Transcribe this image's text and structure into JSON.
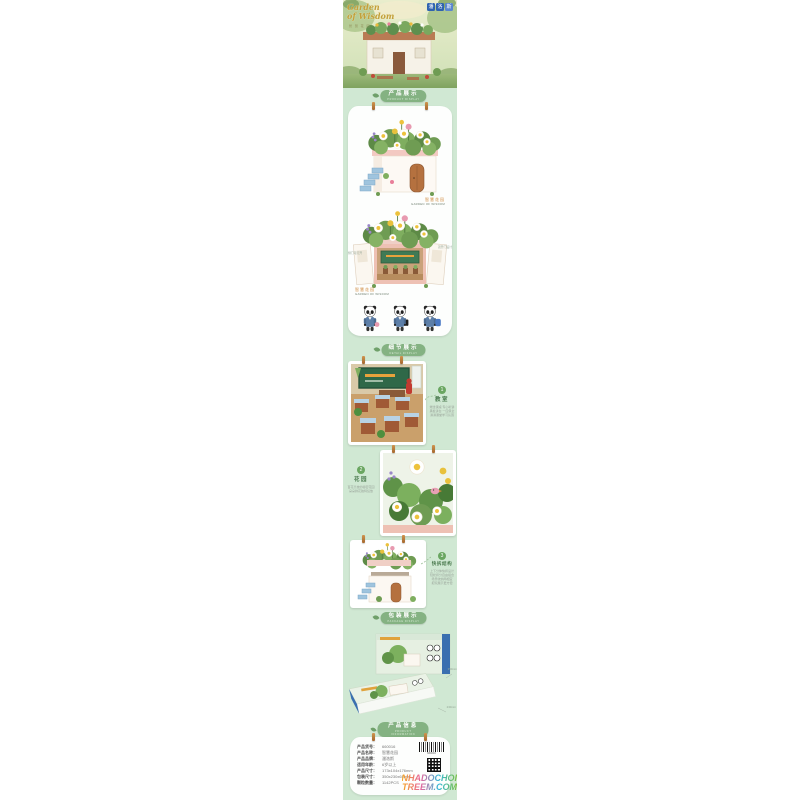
{
  "colors": {
    "strip_bg": "#d0e8d3",
    "badge_green": "#84b282",
    "brand_blue": "#2f63b0",
    "label_green": "#4a7a4e",
    "accent_pink": "#f0cfc6"
  },
  "hero": {
    "title_line1": "Garden",
    "title_line2": "of Wisdom",
    "subtitle": "智 慧 花 园",
    "logo_chars": [
      "潘",
      "洛",
      "斯"
    ]
  },
  "badges": {
    "product": {
      "label": "产品展示",
      "sub": "PRODUCT DISPLAY"
    },
    "detail": {
      "label": "细节展示",
      "sub": "DETAIL DISPLAY"
    },
    "package": {
      "label": "包装展示",
      "sub": "PACKAGE DISPLAY"
    },
    "info": {
      "label": "产品信息",
      "sub": "PRODUCT INFORMATION"
    }
  },
  "product_display": {
    "caption_cn": "智慧花园",
    "caption_en": "GARDEN OF WISDOM",
    "open_caption_cn": "智慧花园",
    "open_caption_en": "GARDEN OF WISDOM",
    "annotation_left": "侧门可打开",
    "annotation_right": "双开门设计"
  },
  "details": {
    "items": [
      {
        "num": "1",
        "title": "教室",
        "desc": [
          "端坐课桌 专心听讲",
          "黑板讲台 一应俱全",
          "满满课堂学习氛围"
        ]
      },
      {
        "num": "2",
        "title": "花园",
        "desc": [
          "百花齐放的秘密花园",
          "朵朵鲜花独特绽放"
        ]
      },
      {
        "num": "3",
        "title": "快拆结构",
        "desc": [
          "上下分体快拆设计",
          "轻松拆分自由组合",
          "场景收纳两相宜",
          "把玩展示更方便"
        ]
      }
    ]
  },
  "package_display": {
    "dim_top": "350mm",
    "dim_right": "230mm"
  },
  "info": {
    "rows": [
      {
        "label": "产品货号：",
        "value": "660016"
      },
      {
        "label": "产品名称：",
        "value": "智慧花园"
      },
      {
        "label": "产品品牌：",
        "value": "潘洛斯"
      },
      {
        "label": "适用年龄：",
        "value": "6岁以上"
      },
      {
        "label": "产品尺寸：",
        "value": "173x104x176mm"
      },
      {
        "label": "包装尺寸：",
        "value": "350x230x65mm"
      },
      {
        "label": "颗粒数量：",
        "value": "1142PCS"
      }
    ],
    "barcode_text": "660016"
  },
  "watermark": {
    "line1": "NHADOCHOI",
    "line2": "TREEM.COM"
  }
}
